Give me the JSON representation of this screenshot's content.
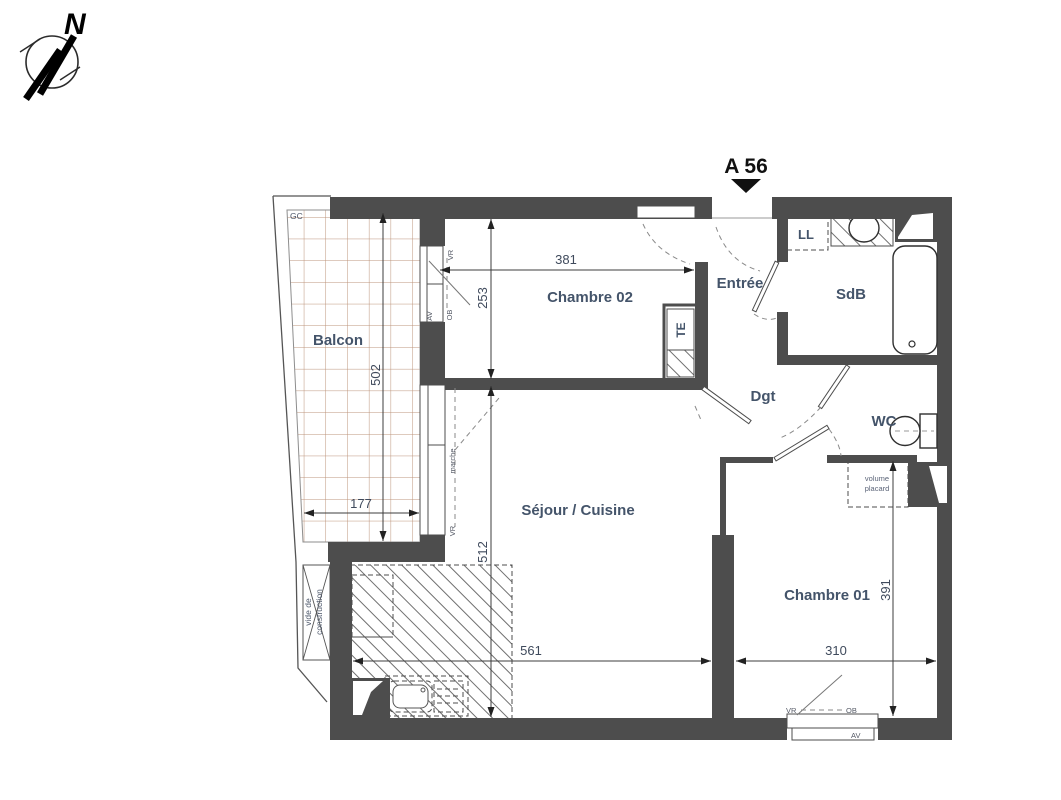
{
  "compass": {
    "north": "N"
  },
  "unit": {
    "label": "A 56"
  },
  "rooms": {
    "balcon": "Balcon",
    "chambre02": "Chambre 02",
    "entree": "Entrée",
    "sdb": "SdB",
    "dgt": "Dgt",
    "wc": "WC",
    "sejour": "Séjour / Cuisine",
    "chambre01": "Chambre 01"
  },
  "dimensions": {
    "chambre02_width": "381",
    "chambre02_depth": "253",
    "balcon_depth": "502",
    "balcon_width": "177",
    "sejour_depth": "512",
    "sejour_width": "561",
    "chambre01_width": "310",
    "chambre01_depth": "391"
  },
  "annotations": {
    "gc": "GC",
    "ll": "LL",
    "te": "TE",
    "vr": "VR",
    "ob": "OB",
    "av": "AV",
    "marche": "marche",
    "volume_placard_line1": "volume",
    "volume_placard_line2": "placard",
    "vide_line1": "vide de",
    "vide_line2": "construction"
  },
  "colors": {
    "wall": "#4d4d4d",
    "room_label": "#44546a",
    "dimension": "#3f4a5c",
    "balcony_grid": "#b5886c",
    "hatch": "#5f5f5f",
    "background": "#ffffff"
  }
}
